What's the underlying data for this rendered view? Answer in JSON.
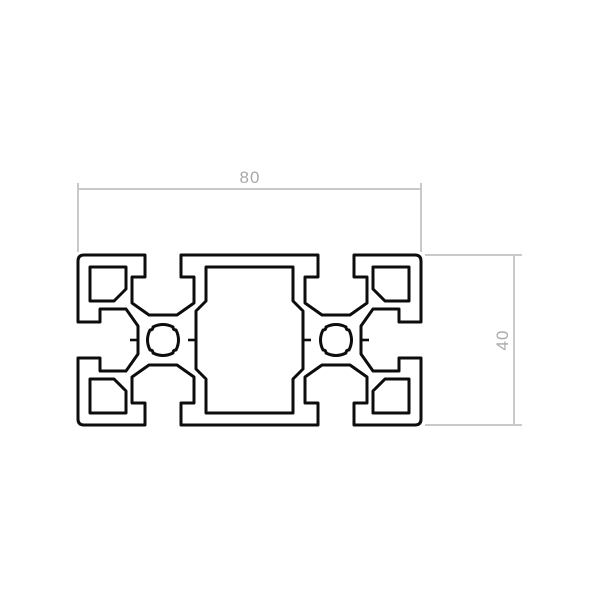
{
  "drawing": {
    "dimensions": {
      "width": {
        "value": "80"
      },
      "height": {
        "value": "40"
      }
    }
  },
  "colors": {
    "background": "#ffffff",
    "profile_stroke": "#0d0d0d",
    "profile_fill": "#ffffff",
    "dimension_line": "#c9c9c9",
    "dimension_text": "#a9a9a9"
  }
}
